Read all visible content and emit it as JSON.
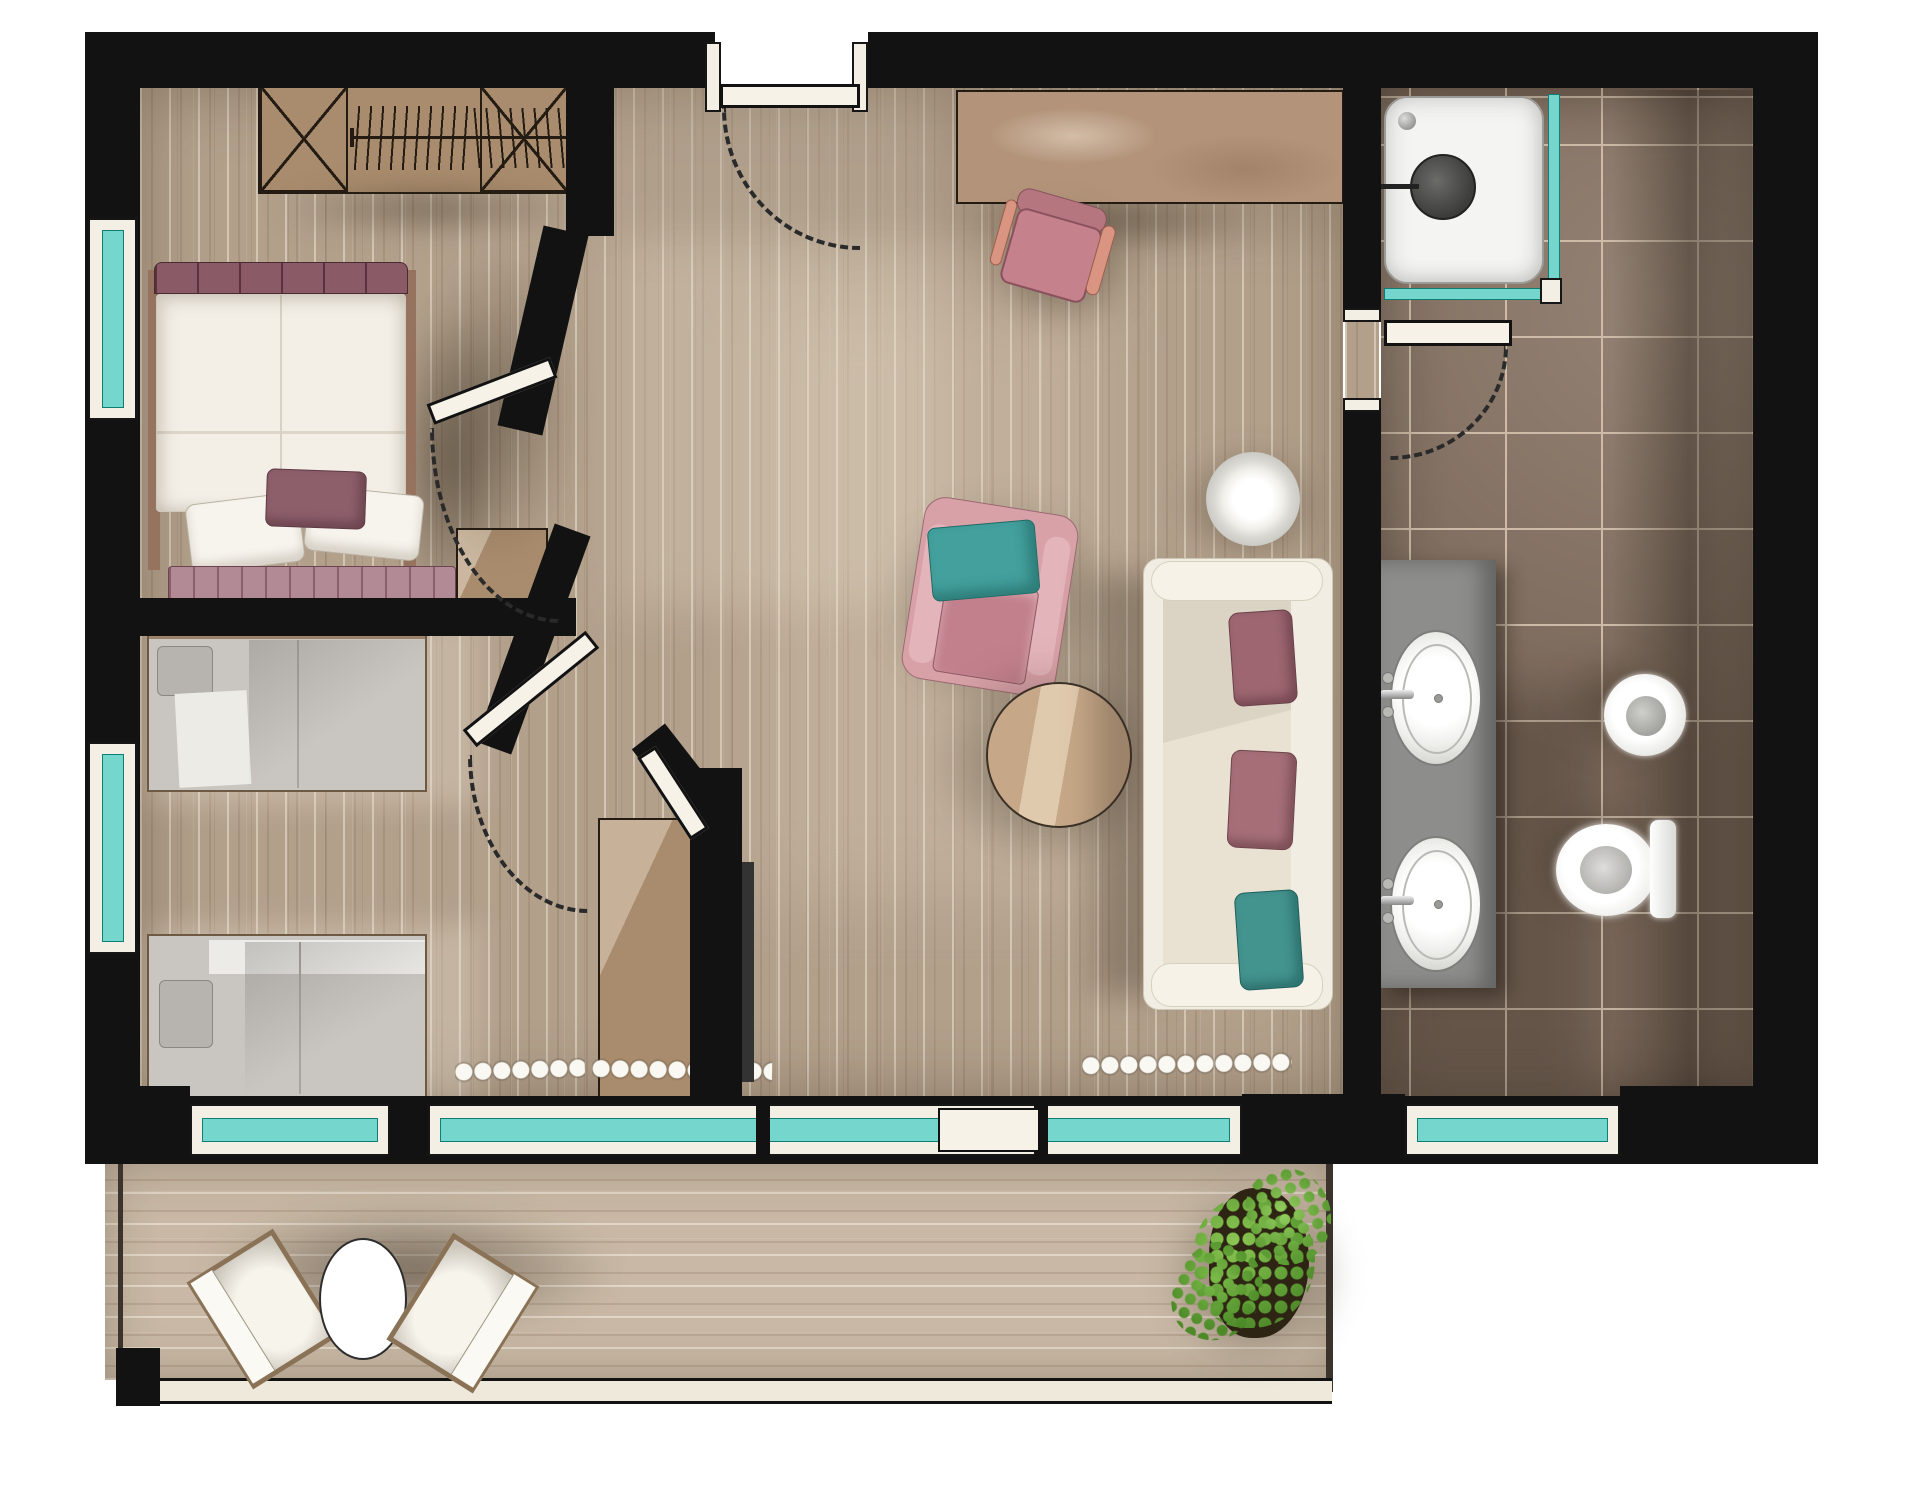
{
  "title": "apartment-suite-floor-plan",
  "style": "hand-rendered watercolor top-down architectural floor plan, no text labels",
  "palette": {
    "wall": "#121212",
    "window_glass": "#74d6cd",
    "wood_floor": "#b2a08b",
    "balcony_floor": "#c8b8a5",
    "bathroom_tile": "#7a685a",
    "tile_grout": "#cdbba8",
    "wood_furniture": "#a98c6d",
    "bed_linen_white": "#f3efe7",
    "plum_textile": "#8d5f6b",
    "pink_armchair": "#d8a1a8",
    "teal_cushion": "#43a09c",
    "gray_twin_bedding": "#c9c5c0",
    "vanity_gray": "#8d8d8b",
    "plant_green": "#6fb04a"
  },
  "rooms": [
    {
      "id": "master-bedroom",
      "label": "Master bedroom",
      "items": [
        "wardrobe with cross-hatched cabinets and hanging rail",
        "double bed with white duvet",
        "two white pillows",
        "plum accent pillow",
        "plum tufted headboard",
        "quilted foot runner",
        "bedside bench",
        "teal window",
        "hinged door with swing arc"
      ]
    },
    {
      "id": "twin-bedroom",
      "label": "Twin bedroom",
      "items": [
        "single bed upper with gray bedding",
        "single bed lower with gray bedding",
        "teal window left wall",
        "teal window bottom wall",
        "hinged door with swing arc",
        "tall wardrobe cabinet"
      ]
    },
    {
      "id": "living-room",
      "label": "Living room and entry",
      "items": [
        "entrance door with swing arc",
        "built-in desk",
        "pink desk chair",
        "pink armchair with teal cushion",
        "round wooden coffee table",
        "round side table",
        "white sofa with two plum and one teal cushion",
        "white curtain ruffles",
        "sliding glazed wall to balcony",
        "tv partition wall"
      ]
    },
    {
      "id": "bathroom",
      "label": "Bathroom",
      "items": [
        "corner shower with teal glass and round drain",
        "hinged door with swing arc",
        "gray double-sink vanity",
        "oval washbasin with chrome tap",
        "oval washbasin with chrome tap",
        "wall-hung bidet",
        "toilet with cistern",
        "dark taupe floor tiles",
        "teal window bottom wall"
      ]
    },
    {
      "id": "balcony",
      "label": "Balcony",
      "items": [
        "cushioned lounge chair left",
        "round bistro table",
        "cushioned lounge chair right",
        "potted green plant",
        "railing"
      ]
    }
  ],
  "counts": {
    "windows_teal": 6,
    "doors": 5,
    "beds": 3,
    "sinks": 2,
    "seats": 6
  }
}
